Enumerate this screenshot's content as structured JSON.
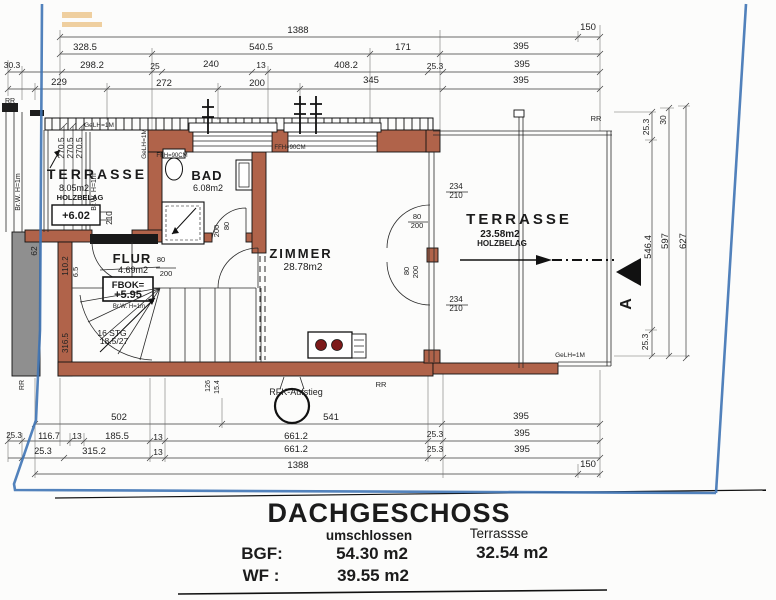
{
  "plan": {
    "drawing_type": "floor plan",
    "rooms": {
      "terrasse_west": {
        "name": "TERRASSE",
        "area": "8.05m2",
        "floor": "HOLZBELAG",
        "level": "+6.02"
      },
      "bad": {
        "name": "BAD",
        "area": "6.08m2"
      },
      "flur": {
        "name": "FLUR",
        "area": "4.69m2",
        "level_label": "FBOK=",
        "level_value": "+5.95",
        "note": "Br.W. H=1m",
        "stairs_line1": "16 STG",
        "stairs_line2": "18.5/27"
      },
      "zimmer": {
        "name": "ZIMMER",
        "area": "28.78m2"
      },
      "terrasse_ost": {
        "name": "TERRASSE",
        "area": "23.58m2",
        "floor": "HOLZBELAG"
      }
    },
    "section_marker": "A"
  },
  "title_block": {
    "title": "DACHGESCHOSS",
    "col1_header": "umschlossen",
    "col2_header": "Terrassse",
    "row1_label": "BGF:",
    "row1_value1": "54.30 m2",
    "row1_value2": "32.54 m2",
    "row2_label": "WF :",
    "row2_value1": "39.55 m2"
  },
  "colors": {
    "wall": "#b0634a",
    "boundary_blue": "#3f74b5",
    "neighbor_wall_gray": "#8f8f8f",
    "burner_red": "#7d1a1a",
    "stamp_orange": "#e09a30"
  },
  "dim_labels": [
    {
      "t": "1388",
      "x": 298,
      "y": 33
    },
    {
      "t": "150",
      "x": 588,
      "y": 30
    },
    {
      "t": "328.5",
      "x": 85,
      "y": 50
    },
    {
      "t": "540.5",
      "x": 261,
      "y": 50
    },
    {
      "t": "171",
      "x": 403,
      "y": 50
    },
    {
      "t": "395",
      "x": 521,
      "y": 49
    },
    {
      "t": "30.3",
      "x": 12,
      "y": 68,
      "s": 8.5
    },
    {
      "t": "298.2",
      "x": 92,
      "y": 68
    },
    {
      "t": "25",
      "x": 155,
      "y": 69,
      "s": 8.5
    },
    {
      "t": "240",
      "x": 211,
      "y": 67
    },
    {
      "t": "13",
      "x": 261,
      "y": 68,
      "s": 8.5
    },
    {
      "t": "408.2",
      "x": 346,
      "y": 68
    },
    {
      "t": "25.3",
      "x": 435,
      "y": 69,
      "s": 8.5
    },
    {
      "t": "395",
      "x": 522,
      "y": 67
    },
    {
      "t": "229",
      "x": 59,
      "y": 85
    },
    {
      "t": "272",
      "x": 164,
      "y": 86
    },
    {
      "t": "200",
      "x": 257,
      "y": 86
    },
    {
      "t": "345",
      "x": 371,
      "y": 83
    },
    {
      "t": "395",
      "x": 521,
      "y": 83
    },
    {
      "t": "502",
      "x": 119,
      "y": 420
    },
    {
      "t": "541",
      "x": 331,
      "y": 420
    },
    {
      "t": "395",
      "x": 521,
      "y": 419
    },
    {
      "t": "25.3",
      "x": 14,
      "y": 438,
      "s": 8
    },
    {
      "t": "116.7",
      "x": 49,
      "y": 439,
      "s": 9
    },
    {
      "t": "13",
      "x": 77,
      "y": 439,
      "s": 8.5
    },
    {
      "t": "185.5",
      "x": 117,
      "y": 439
    },
    {
      "t": "13",
      "x": 158,
      "y": 440,
      "s": 8.5
    },
    {
      "t": "661.2",
      "x": 296,
      "y": 439
    },
    {
      "t": "25.3",
      "x": 435,
      "y": 437,
      "s": 8.5
    },
    {
      "t": "395",
      "x": 522,
      "y": 436
    },
    {
      "t": "25.3",
      "x": 43,
      "y": 454,
      "s": 9
    },
    {
      "t": "315.2",
      "x": 94,
      "y": 454
    },
    {
      "t": "13",
      "x": 158,
      "y": 455,
      "s": 8.5
    },
    {
      "t": "661.2",
      "x": 296,
      "y": 452
    },
    {
      "t": "25.3",
      "x": 435,
      "y": 452,
      "s": 8.5
    },
    {
      "t": "395",
      "x": 522,
      "y": 452
    },
    {
      "t": "1388",
      "x": 298,
      "y": 468
    },
    {
      "t": "150",
      "x": 588,
      "y": 467
    },
    {
      "t": "25.3",
      "x": 649,
      "y": 127,
      "r": -90,
      "s": 8.5
    },
    {
      "t": "30",
      "x": 666,
      "y": 120,
      "r": -90,
      "s": 8.5
    },
    {
      "t": "546.4",
      "x": 651,
      "y": 247,
      "r": -90
    },
    {
      "t": "597",
      "x": 668,
      "y": 241,
      "r": -90
    },
    {
      "t": "627",
      "x": 686,
      "y": 241,
      "r": -90
    },
    {
      "t": "25.3",
      "x": 648,
      "y": 342,
      "r": -90,
      "s": 8.5
    },
    {
      "t": "270.5",
      "x": 64,
      "y": 148,
      "r": -90,
      "s": 8.5
    },
    {
      "t": "270.5",
      "x": 73,
      "y": 148,
      "r": -90,
      "s": 8.5
    },
    {
      "t": "270.5",
      "x": 82,
      "y": 148,
      "r": -90,
      "s": 8.5
    },
    {
      "t": "62",
      "x": 37,
      "y": 251,
      "r": -90,
      "s": 8.5
    },
    {
      "t": "110.2",
      "x": 68,
      "y": 266,
      "r": -90,
      "s": 8
    },
    {
      "t": "6.5",
      "x": 78,
      "y": 272,
      "r": -90,
      "s": 7.5
    },
    {
      "t": "316.5",
      "x": 68,
      "y": 343,
      "r": -90,
      "s": 8
    },
    {
      "t": "210",
      "x": 112,
      "y": 218,
      "r": -90,
      "s": 8
    },
    {
      "t": "GeLH=1M",
      "x": 99,
      "y": 127,
      "s": 6.5
    },
    {
      "t": "GeLH=1M",
      "x": 146,
      "y": 144,
      "r": -90,
      "s": 6.5
    },
    {
      "t": "GeLH=1M",
      "x": 570,
      "y": 357,
      "s": 6.5
    },
    {
      "t": "FFH=90CM",
      "x": 172,
      "y": 157,
      "s": 6
    },
    {
      "t": "FFH=90CM",
      "x": 290,
      "y": 149,
      "s": 6
    },
    {
      "t": "RR",
      "x": 596,
      "y": 121,
      "s": 7.5
    },
    {
      "t": "RR",
      "x": 381,
      "y": 387,
      "s": 7.5
    },
    {
      "t": "RR",
      "x": 10,
      "y": 103,
      "s": 7
    },
    {
      "t": "RR",
      "x": 24,
      "y": 385,
      "r": -90,
      "s": 7
    },
    {
      "t": "RFK-Aufstieg",
      "x": 296,
      "y": 395,
      "s": 9
    },
    {
      "t": "Br.W. H=1m",
      "x": 20,
      "y": 192,
      "r": -90,
      "s": 7
    },
    {
      "t": "Br.W. H=1m",
      "x": 96,
      "y": 192,
      "r": -90,
      "s": 7
    },
    {
      "t": "Br.W. H=1m",
      "x": 129,
      "y": 308,
      "s": 6
    },
    {
      "t": "234",
      "x": 456,
      "y": 189,
      "s": 8
    },
    {
      "t": "210",
      "x": 456,
      "y": 198,
      "s": 8
    },
    {
      "t": "234",
      "x": 456,
      "y": 302,
      "s": 8
    },
    {
      "t": "210",
      "x": 456,
      "y": 311,
      "s": 8
    },
    {
      "t": "80",
      "x": 417,
      "y": 219,
      "s": 7.5
    },
    {
      "t": "200",
      "x": 417,
      "y": 228,
      "s": 7.5
    },
    {
      "t": "80",
      "x": 409,
      "y": 271,
      "r": -90,
      "s": 7.5
    },
    {
      "t": "200",
      "x": 418,
      "y": 272,
      "r": -90,
      "s": 7.5
    },
    {
      "t": "200",
      "x": 219,
      "y": 231,
      "r": -90,
      "s": 7.5
    },
    {
      "t": "80",
      "x": 229,
      "y": 226,
      "r": -90,
      "s": 7.5
    },
    {
      "t": "80",
      "x": 161,
      "y": 262,
      "s": 7.5
    },
    {
      "t": "200",
      "x": 166,
      "y": 276,
      "s": 7.5
    },
    {
      "t": "126",
      "x": 210,
      "y": 386,
      "r": -90,
      "s": 7
    },
    {
      "t": "15.4",
      "x": 219,
      "y": 387,
      "r": -90,
      "s": 7
    }
  ]
}
